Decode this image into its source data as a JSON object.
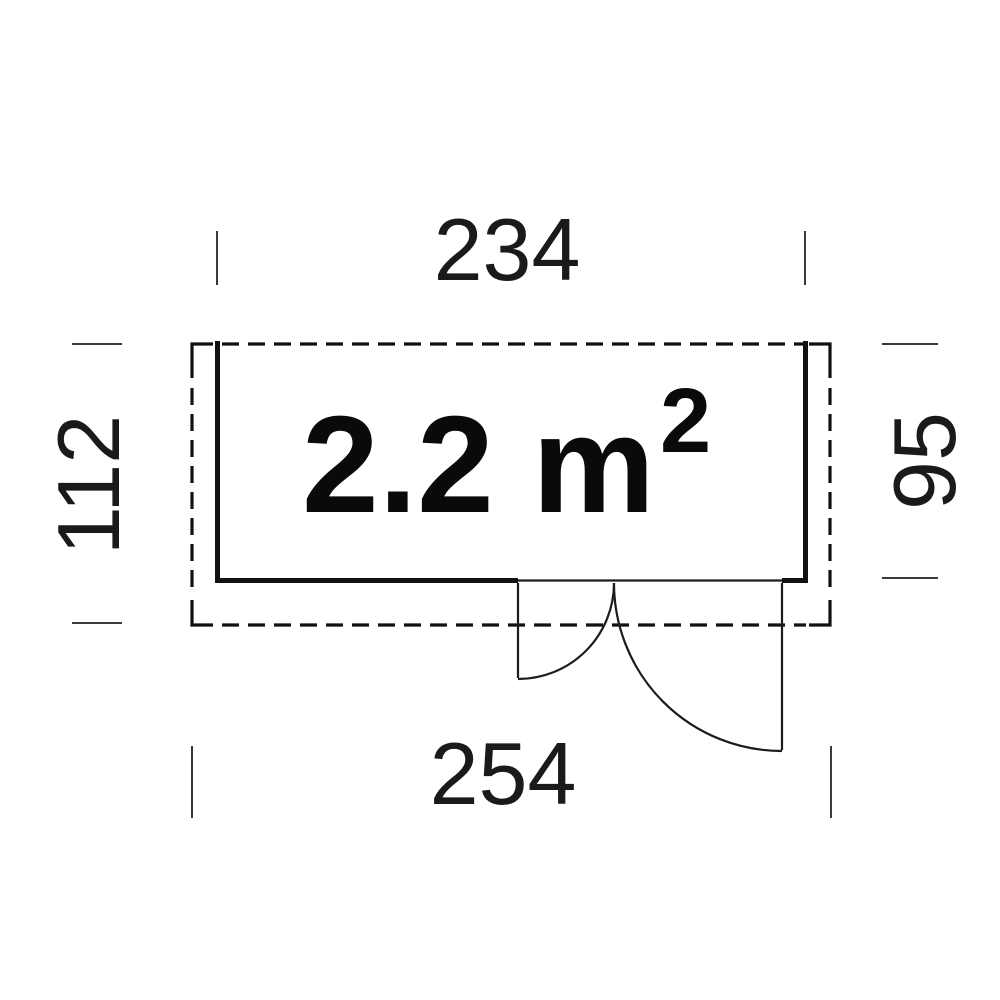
{
  "floor_plan": {
    "area_label": {
      "value": "2.2 m",
      "exponent": "2"
    },
    "dimensions": {
      "top": "234",
      "left": "112",
      "right": "95",
      "bottom": "254"
    },
    "colors": {
      "background": "#ffffff",
      "wall_line": "#111111",
      "roof_dashed_line": "#111111",
      "door_line": "#1c1c1c",
      "tick_line": "#3a3a3a",
      "text": "#1a1a1a",
      "area_text": "#0a0a0a"
    }
  }
}
